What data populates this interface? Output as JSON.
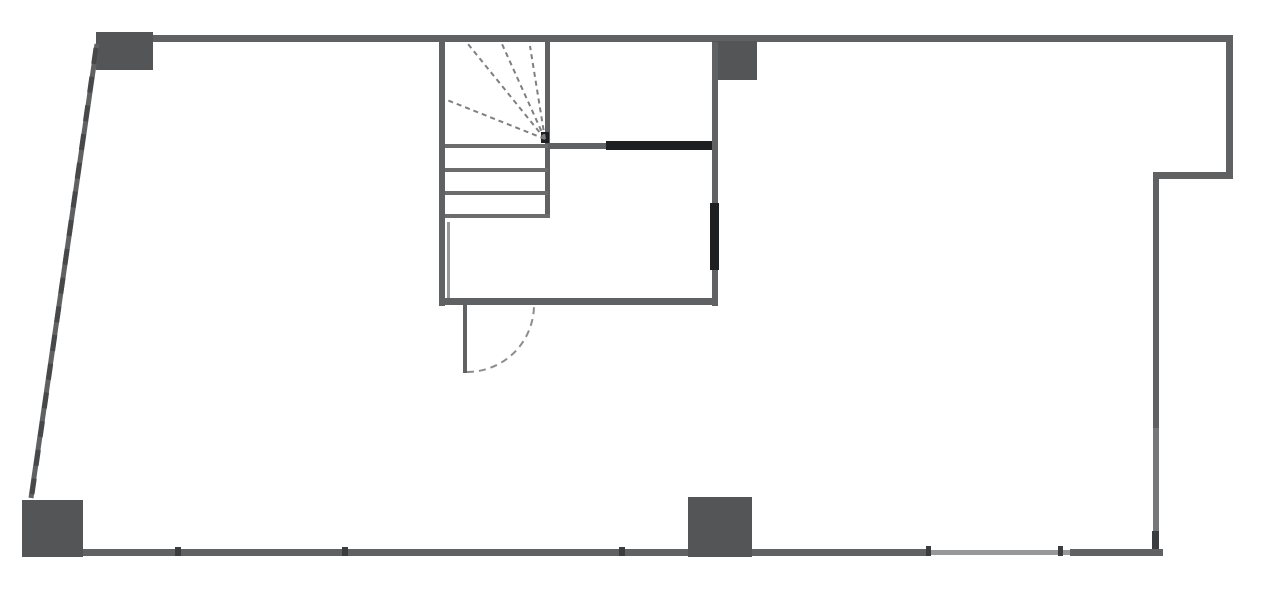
{
  "drawing": {
    "kind": "architectural-floor-plan",
    "canvas": {
      "width": 1280,
      "height": 601,
      "background": "#ffffff"
    },
    "palette": {
      "wall": "#606162",
      "wall_soft": "#767778",
      "wall_light": "#97989a",
      "wall_dark": "#1e1f20",
      "column": "#545556",
      "tread": "#6b6c6d",
      "fan": "#7e7f81",
      "arc": "#8c8d8f",
      "joint": "#3b3c3d",
      "hatch": "#47484a"
    },
    "rects": [
      {
        "name": "top-wall",
        "x": 97,
        "y": 35,
        "w": 1136,
        "h": 7,
        "c": "wall"
      },
      {
        "name": "column-top-left",
        "x": 96,
        "y": 32,
        "w": 57,
        "h": 38,
        "c": "column"
      },
      {
        "name": "column-top-middle",
        "x": 712,
        "y": 41,
        "w": 45,
        "h": 39,
        "c": "column"
      },
      {
        "name": "right-wall-upper",
        "x": 1226,
        "y": 35,
        "w": 7,
        "h": 144,
        "c": "wall"
      },
      {
        "name": "right-notch-wall",
        "x": 1153,
        "y": 172,
        "w": 80,
        "h": 7,
        "c": "wall"
      },
      {
        "name": "right-wall-middle",
        "x": 1153,
        "y": 172,
        "w": 6,
        "h": 256,
        "c": "wall"
      },
      {
        "name": "right-wall-lower",
        "x": 1153,
        "y": 428,
        "w": 6,
        "h": 128,
        "c": "wall_soft"
      },
      {
        "name": "bottom-wall-left",
        "x": 80,
        "y": 549,
        "w": 850,
        "h": 7,
        "c": "wall"
      },
      {
        "name": "bottom-wall-window",
        "x": 930,
        "y": 550,
        "w": 140,
        "h": 5,
        "c": "wall_light"
      },
      {
        "name": "bottom-wall-right",
        "x": 1070,
        "y": 549,
        "w": 93,
        "h": 7,
        "c": "wall"
      },
      {
        "name": "column-bottom-left",
        "x": 22,
        "y": 500,
        "w": 61,
        "h": 57,
        "c": "column"
      },
      {
        "name": "column-bottom-middle",
        "x": 688,
        "y": 497,
        "w": 64,
        "h": 60,
        "c": "column"
      },
      {
        "name": "stair-left-wall",
        "x": 439,
        "y": 42,
        "w": 6,
        "h": 264,
        "c": "wall"
      },
      {
        "name": "stair-left-inner-face",
        "x": 447,
        "y": 222,
        "w": 3,
        "h": 76,
        "c": "wall_light"
      },
      {
        "name": "stair-right-edge",
        "x": 545,
        "y": 42,
        "w": 5,
        "h": 176,
        "c": "wall"
      },
      {
        "name": "mid-wall",
        "x": 548,
        "y": 143,
        "w": 170,
        "h": 6,
        "c": "wall"
      },
      {
        "name": "mid-wall-dark-segment",
        "x": 606,
        "y": 141,
        "w": 112,
        "h": 9,
        "c": "wall_dark"
      },
      {
        "name": "interior-wall",
        "x": 712,
        "y": 42,
        "w": 6,
        "h": 264,
        "c": "wall"
      },
      {
        "name": "interior-wall-dark-segment",
        "x": 710,
        "y": 203,
        "w": 9,
        "h": 67,
        "c": "wall_dark"
      },
      {
        "name": "hall-bottom-wall",
        "x": 439,
        "y": 298,
        "w": 279,
        "h": 7,
        "c": "wall"
      },
      {
        "name": "door-leaf",
        "x": 463,
        "y": 305,
        "w": 4,
        "h": 68,
        "c": "wall"
      },
      {
        "name": "stair-tread-1",
        "x": 445,
        "y": 144,
        "w": 103,
        "h": 4,
        "c": "tread"
      },
      {
        "name": "stair-tread-2",
        "x": 445,
        "y": 168,
        "w": 103,
        "h": 4,
        "c": "tread"
      },
      {
        "name": "stair-tread-3",
        "x": 445,
        "y": 191,
        "w": 103,
        "h": 4,
        "c": "tread"
      },
      {
        "name": "stair-tread-4",
        "x": 445,
        "y": 214,
        "w": 105,
        "h": 4,
        "c": "tread"
      },
      {
        "name": "stair-winder-pivot",
        "x": 541,
        "y": 132,
        "w": 8,
        "h": 11,
        "c": "wall_dark"
      },
      {
        "name": "bottom-wall-joint-1",
        "x": 175,
        "y": 547,
        "w": 6,
        "h": 9,
        "c": "joint"
      },
      {
        "name": "bottom-wall-joint-2",
        "x": 342,
        "y": 547,
        "w": 6,
        "h": 9,
        "c": "joint"
      },
      {
        "name": "bottom-wall-joint-3",
        "x": 619,
        "y": 547,
        "w": 6,
        "h": 9,
        "c": "joint"
      },
      {
        "name": "bottom-wall-joint-4",
        "x": 926,
        "y": 546,
        "w": 5,
        "h": 10,
        "c": "joint"
      },
      {
        "name": "bottom-wall-joint-5",
        "x": 1058,
        "y": 546,
        "w": 5,
        "h": 10,
        "c": "joint"
      },
      {
        "name": "right-wall-corner-nub",
        "x": 1152,
        "y": 531,
        "w": 7,
        "h": 18,
        "c": "joint"
      }
    ],
    "lines": [
      {
        "name": "left-slanted-wall",
        "x1": 97,
        "y1": 44,
        "x2": 31,
        "y2": 498,
        "w": 5,
        "c": "wall"
      },
      {
        "name": "left-slanted-wall-hatch",
        "x1": 96,
        "y1": 48,
        "x2": 32,
        "y2": 494,
        "w": 5,
        "c": "hatch",
        "dash": "16 13"
      },
      {
        "name": "winder-ray-left",
        "x1": 545,
        "y1": 139,
        "x2": 447,
        "y2": 100,
        "w": 2,
        "c": "fan",
        "dash": "5 4"
      },
      {
        "name": "winder-ray-mid-left",
        "x1": 545,
        "y1": 139,
        "x2": 468,
        "y2": 44,
        "w": 2,
        "c": "fan",
        "dash": "5 4"
      },
      {
        "name": "winder-ray-mid-right",
        "x1": 545,
        "y1": 139,
        "x2": 502,
        "y2": 44,
        "w": 2,
        "c": "fan",
        "dash": "5 4"
      },
      {
        "name": "winder-ray-right",
        "x1": 545,
        "y1": 139,
        "x2": 530,
        "y2": 46,
        "w": 2,
        "c": "fan",
        "dash": "5 4"
      }
    ],
    "paths": [
      {
        "name": "door-swing-arc",
        "d": "M 467 372 A 67 67 0 0 0 534 305",
        "w": 2,
        "c": "arc",
        "dash": "7 5"
      }
    ]
  }
}
